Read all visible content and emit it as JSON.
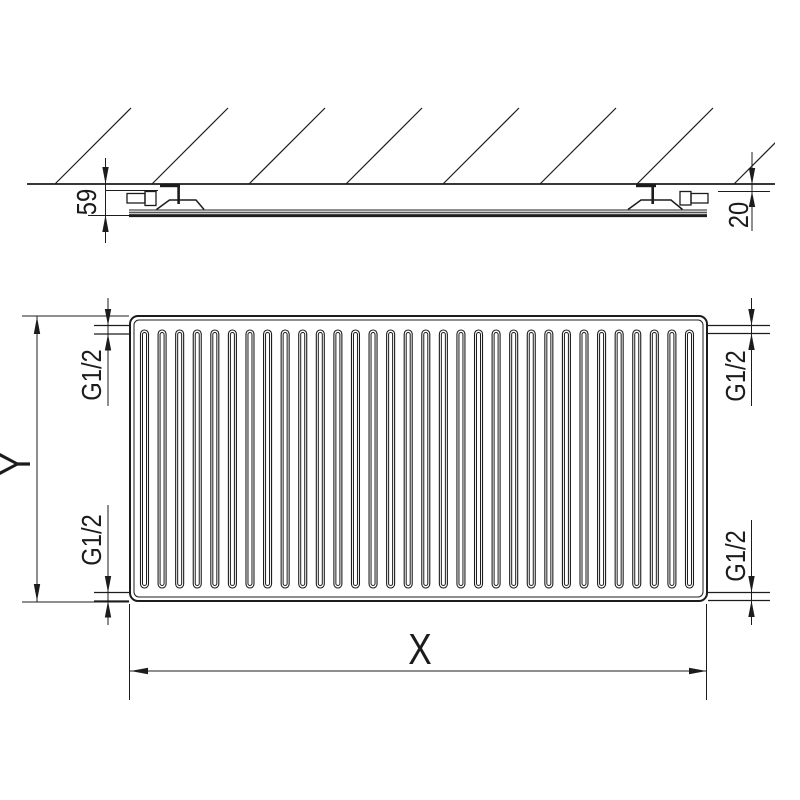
{
  "drawing": {
    "side_view": {
      "depth_dimension": "59",
      "wall_gap_dimension": "20"
    },
    "front_view": {
      "height_dimension": "Y",
      "width_dimension": "X",
      "connection_thread": "G1/2"
    },
    "colors": {
      "line": "#1c1c1c",
      "background": "#ffffff"
    }
  }
}
